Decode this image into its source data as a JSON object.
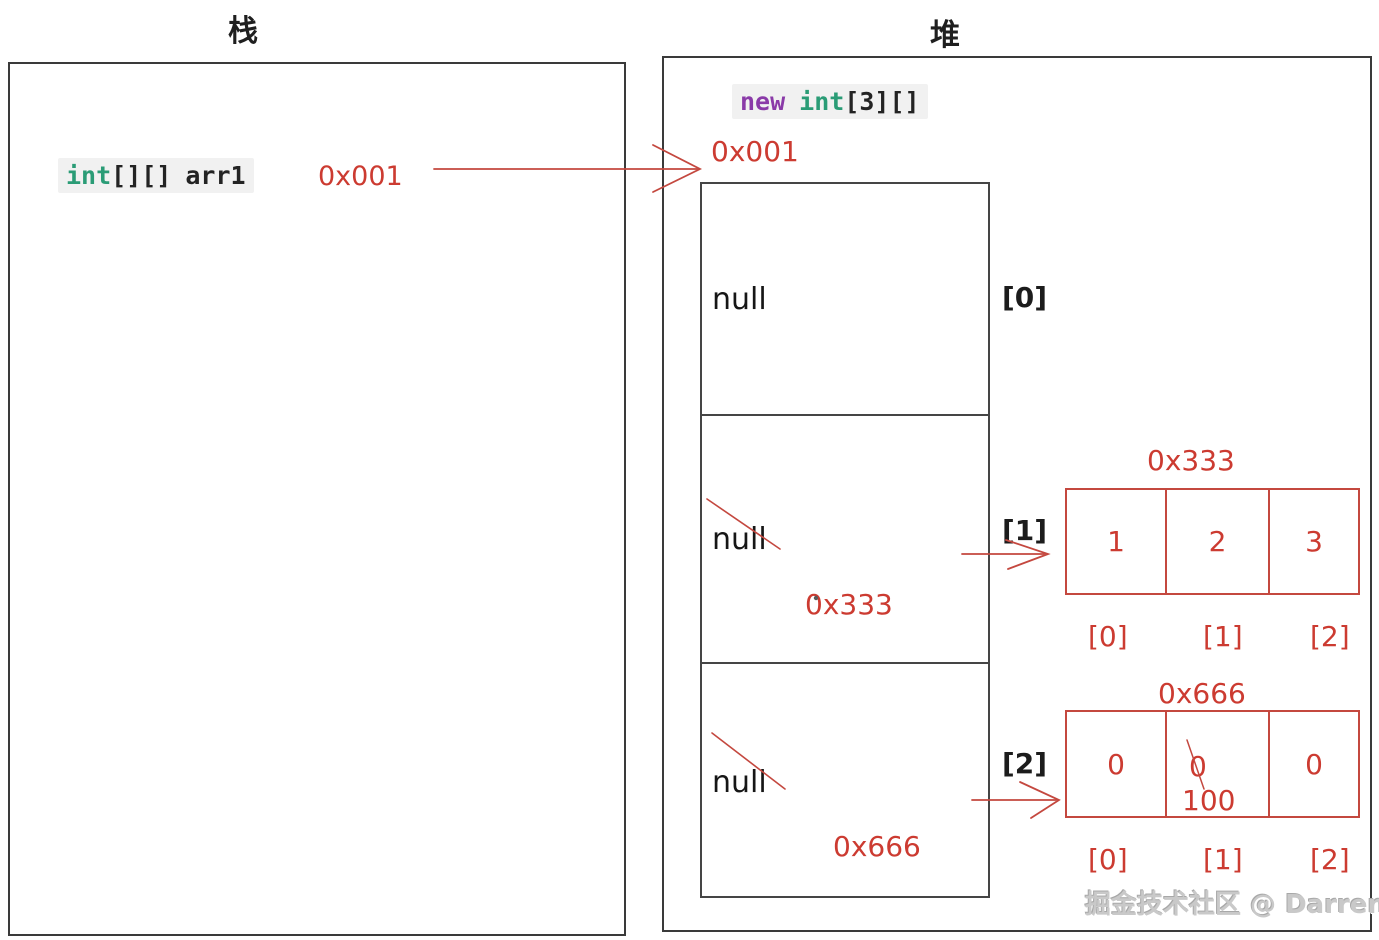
{
  "stack": {
    "title": "栈",
    "code": {
      "type_kw": "int",
      "brackets": "[][]",
      "var_name": "arr1"
    },
    "address": "0x001"
  },
  "heap": {
    "title": "堆",
    "code": {
      "new_kw": "new",
      "type_kw": "int",
      "brackets": "[3][]"
    },
    "address_label": "0x001",
    "outer_array": {
      "cells": [
        {
          "value": "null",
          "index_label": "[0]",
          "address": ""
        },
        {
          "value": "null",
          "index_label": "[1]",
          "address": "0x333"
        },
        {
          "value": "null",
          "index_label": "[2]",
          "address": "0x666"
        }
      ]
    },
    "array_333": {
      "title": "0x333",
      "values": [
        "1",
        "2",
        "3"
      ],
      "index_labels": [
        "[0]",
        "[1]",
        "[2]"
      ]
    },
    "array_666": {
      "title": "0x666",
      "values": [
        "0",
        "0",
        "0"
      ],
      "new_value": "100",
      "index_labels": [
        "[0]",
        "[1]",
        "[2]"
      ]
    }
  },
  "watermark": "掘金技术社区 @ Darren",
  "colors": {
    "red": "#cc3b31",
    "red_border": "#c4483f",
    "type_keyword_green": "#2a9c76",
    "new_keyword_purple": "#8a3aa8",
    "box_border_gray": "#3a3a3a"
  }
}
